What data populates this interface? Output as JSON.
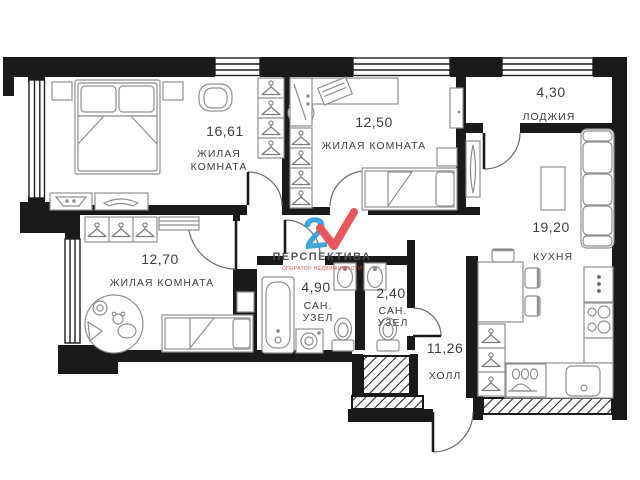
{
  "plan": {
    "watermark": {
      "brand": "ПЕРСПЕКТИВА",
      "logo_digit": "2",
      "tagline": "ОПЕРАТОР НЕДВИЖИМОСТИ"
    },
    "colors": {
      "wall": "#1a1a1a",
      "furniture_stroke": "#8f8f8f",
      "label_text": "#3f3f3f",
      "logo_blue": "#2e9fd8",
      "logo_red": "#e8474e"
    },
    "rooms": [
      {
        "area": "16,61",
        "name_lines": [
          "ЖИЛАЯ",
          "КОМНАТА"
        ]
      },
      {
        "area": "12,50",
        "name_lines": [
          "ЖИЛАЯ КОМНАТА"
        ]
      },
      {
        "area": "4,30",
        "name_lines": [
          "ЛОДЖИЯ"
        ]
      },
      {
        "area": "19,20",
        "name_lines": [
          "КУХНЯ"
        ]
      },
      {
        "area": "12,70",
        "name_lines": [
          "ЖИЛАЯ КОМНАТА"
        ]
      },
      {
        "area": "4,90",
        "name_lines": [
          "САН.",
          "УЗЕЛ"
        ]
      },
      {
        "area": "2,40",
        "name_lines": [
          "САН.",
          "УЗЕЛ"
        ]
      },
      {
        "area": "11,26",
        "name_lines": [
          "ХОЛЛ"
        ]
      }
    ]
  }
}
